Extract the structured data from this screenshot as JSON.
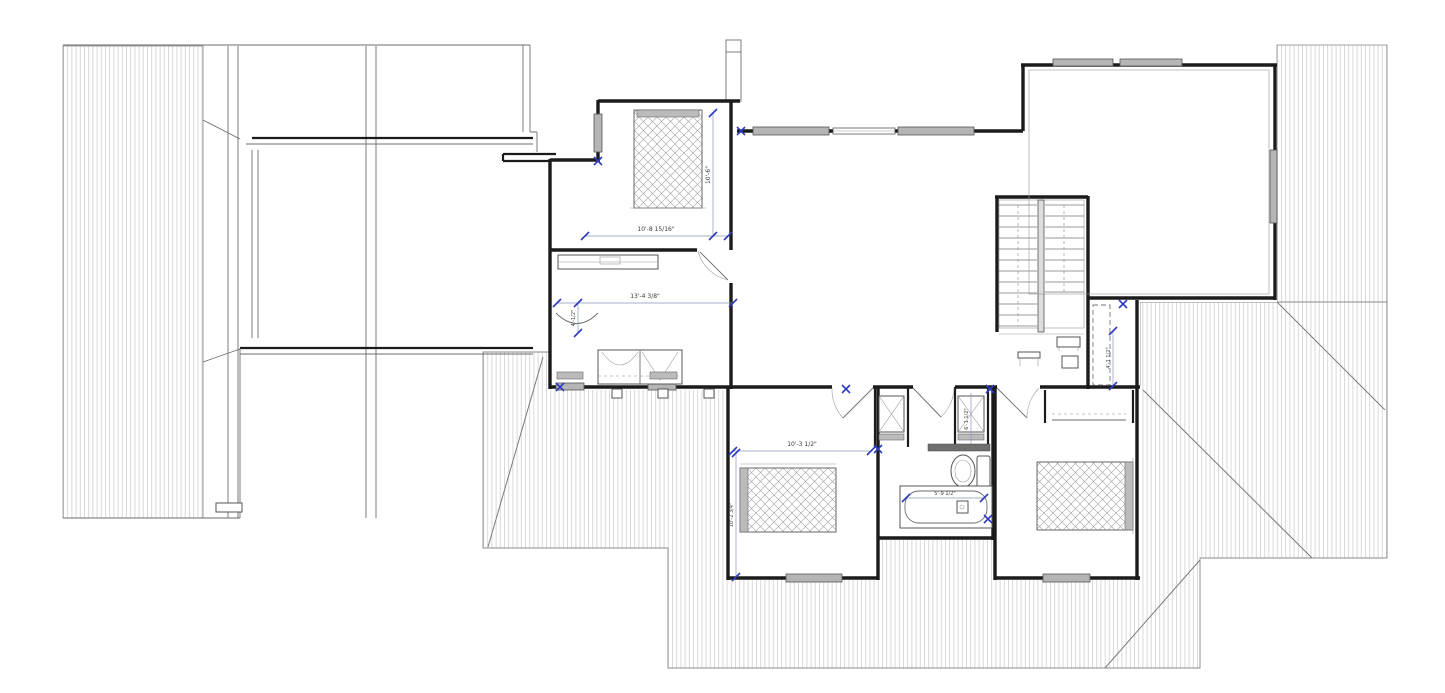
{
  "drawing": {
    "type": "floor-plan",
    "dimensions": {
      "bedroom2_width": "10'-8 15/16\"",
      "bedroom2_depth": "10'-6\"",
      "dressing_room_width": "13'-4 3/8\"",
      "dressing_closet_depth": "4'-1/2\"",
      "bedroom3_width": "10'-3 1/2\"",
      "bedroom3_depth": "10'-2 3/4\"",
      "bathtub_length": "5'-9 1/2\"",
      "landing_niche_depth": "4'-1 1/2\"",
      "laundry_closet_depth": "6'-1 1/2\""
    },
    "colors": {
      "wall": "#1b1b1b",
      "roof_hatch": "#c9c9c9",
      "window_fill": "#b5b5b5",
      "dimension_accent": "#2f3bbf",
      "linework": "#6e6e6e",
      "background": "#ffffff"
    }
  }
}
